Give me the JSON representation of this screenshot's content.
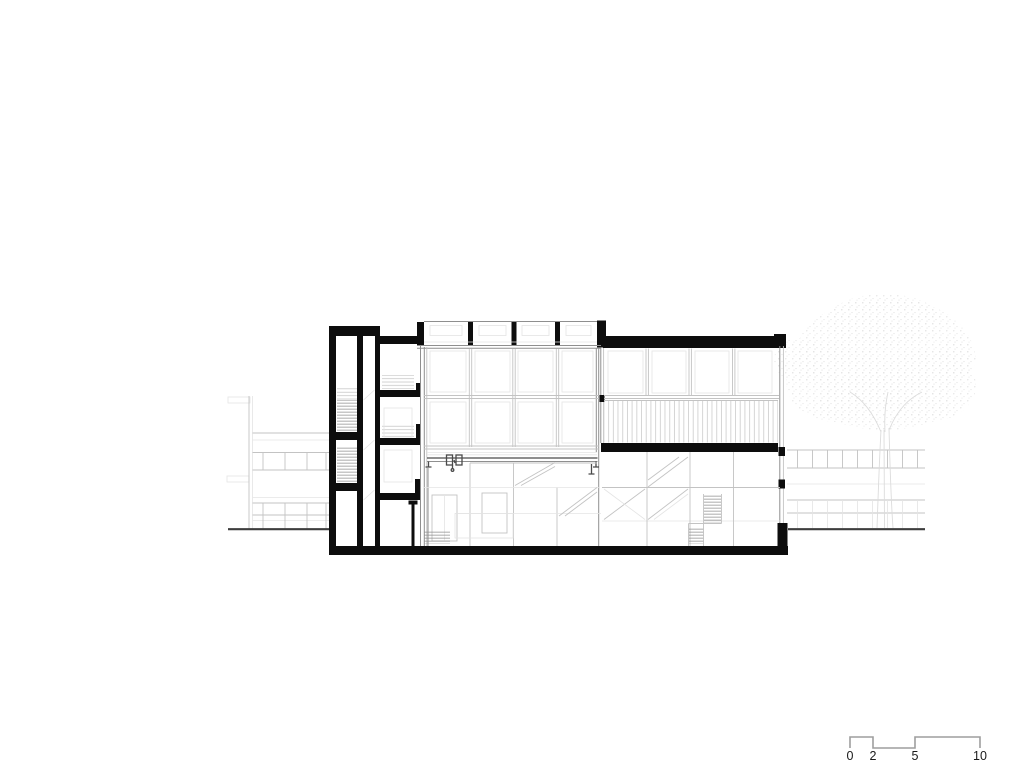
{
  "colors": {
    "paper": "#ffffff",
    "ink": "#0d0d0d",
    "dark": "#4a4a4a",
    "mid": "#8f8f8f",
    "faint": "#c3c3c3",
    "fainter": "#e4e4e4",
    "ground": "#3d3d3d",
    "tree_dot": "#c9c9c9",
    "tree_line": "#dcdcdc",
    "scale_line": "#9e9e9e",
    "label": "#1a1a1a"
  },
  "scale_bar": {
    "labels": [
      "0",
      "2",
      "5",
      "10"
    ]
  }
}
